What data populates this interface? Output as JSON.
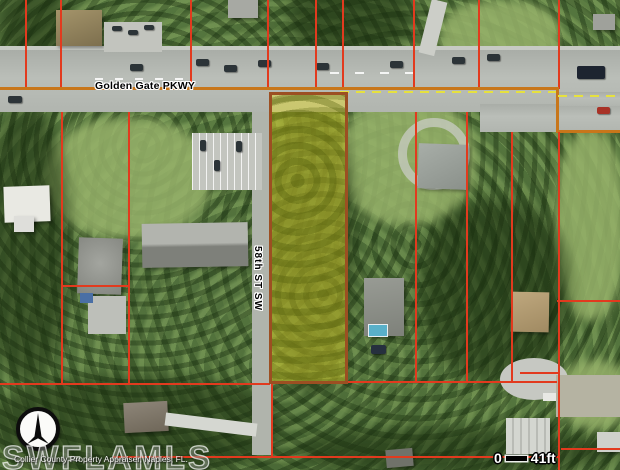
{
  "map": {
    "road_labels": {
      "golden_gate_pkwy": "Golden Gate PKWY",
      "fifty_eighth_st_sw": "58th ST SW"
    },
    "scale_bar": {
      "zero_label": "0",
      "distance_label": "41ft"
    },
    "watermark_text": "SWFLAMLS",
    "attribution_text": "Collier County Property Appraiser, Naples, FL.",
    "compass": {
      "icon": "north-arrow-icon"
    },
    "colors": {
      "parcel_boundary_line": "#e23a1e",
      "road_boundary_line": "#c8761a",
      "highlight_parcel_fill": "#ded83a",
      "highlight_parcel_border": "#9c4f22",
      "road_surface": "#b3b7b1",
      "label_text": "#000000",
      "scale_text": "#ffffff"
    }
  }
}
